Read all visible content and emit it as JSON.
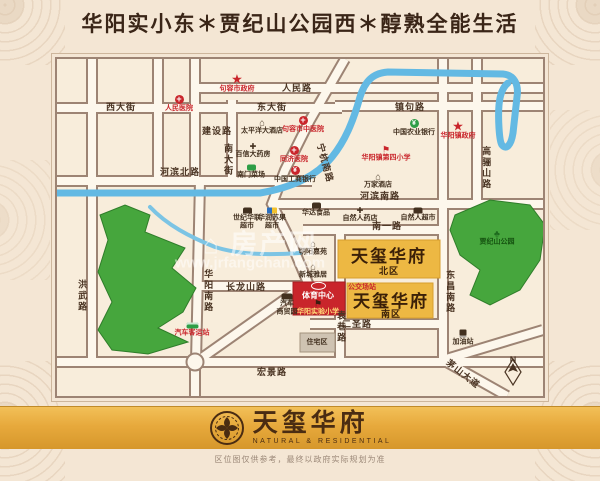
{
  "page": {
    "title": "华阳实小东＊贾纪山公园西＊醇熟全能生活",
    "disclaimer": "区位图仅供参考，最终以政府实际规划为准"
  },
  "logo": {
    "name": "天玺华府",
    "tagline": "NATURAL & RESIDENTIAL"
  },
  "watermark": {
    "text": "⌂ 房产网",
    "url": "www.jrfangchan.com"
  },
  "colors": {
    "background": "#f4e6d4",
    "map_background": "#f8eddb",
    "road_line": "#9d8474",
    "road_fill": "#fdf7ec",
    "river": "#63b9e3",
    "park": "#46a63d",
    "block_yellow": "#edb843",
    "block_red": "#c9252b",
    "banner_gold": "#e7a93c",
    "accent_red": "#c9252b",
    "text_dark": "#4a3423"
  },
  "map": {
    "labels": [
      {
        "text": "人民路",
        "x": 242,
        "y": 31,
        "cls": "road",
        "name": "road-renminlu"
      },
      {
        "text": "东大街",
        "x": 217,
        "y": 50,
        "cls": "road",
        "name": "road-dongdajie"
      },
      {
        "text": "西大街",
        "x": 66,
        "y": 50,
        "cls": "road",
        "name": "road-xidajie"
      },
      {
        "text": "建设路",
        "x": 162,
        "y": 74,
        "cls": "road",
        "name": "road-jianshelu"
      },
      {
        "text": "南大街",
        "x": 173,
        "y": 103,
        "cls": "road-v",
        "name": "road-nandajie"
      },
      {
        "text": "河滨北路",
        "x": 125,
        "y": 115,
        "cls": "road",
        "name": "road-hebinbeilu"
      },
      {
        "text": "宁杭南路",
        "x": 270,
        "y": 106,
        "cls": "road",
        "rot": 75,
        "name": "road-ninghangnanlu"
      },
      {
        "text": "镇句路",
        "x": 355,
        "y": 50,
        "cls": "road",
        "name": "road-zhenjulu"
      },
      {
        "text": "河滨南路",
        "x": 325,
        "y": 139,
        "cls": "road",
        "name": "road-hebinnanlu"
      },
      {
        "text": "南一路",
        "x": 332,
        "y": 169,
        "cls": "road",
        "name": "road-nanyilu"
      },
      {
        "text": "高骊山路",
        "x": 431,
        "y": 111,
        "cls": "road-v",
        "name": "road-gaolishanlu"
      },
      {
        "text": "长龙山路",
        "x": 191,
        "y": 230,
        "cls": "road",
        "name": "road-changlongshanlu"
      },
      {
        "text": "华阳南路",
        "x": 153,
        "y": 234,
        "cls": "road-v",
        "name": "road-huayangnanlu"
      },
      {
        "text": "洪武路",
        "x": 27,
        "y": 239,
        "cls": "road-v",
        "name": "road-hongwulu"
      },
      {
        "text": "东昌南路",
        "x": 395,
        "y": 235,
        "cls": "road-v",
        "name": "road-dongchangnanlu"
      },
      {
        "text": "二圣路",
        "x": 302,
        "y": 267,
        "cls": "road",
        "name": "road-ershenglu"
      },
      {
        "text": "袁巷路",
        "x": 286,
        "y": 270,
        "cls": "road-v",
        "name": "road-yuanxianglu"
      },
      {
        "text": "宏景路",
        "x": 217,
        "y": 315,
        "cls": "road",
        "name": "road-hongjinglu"
      },
      {
        "text": "茅山大道",
        "x": 408,
        "y": 317,
        "cls": "road",
        "rot": 38,
        "name": "road-maoshandadao"
      },
      {
        "text": "句容市政府",
        "x": 182,
        "y": 27,
        "cls": "poi-red",
        "icon": "star",
        "iconName": "government-star-icon",
        "name": "poi-jurong-government"
      },
      {
        "text": "人民医院",
        "x": 124,
        "y": 47,
        "cls": "poi-red",
        "icon": "cross",
        "iconName": "hospital-cross-icon",
        "name": "poi-renmin-hospital"
      },
      {
        "text": "句容市中医院",
        "x": 248,
        "y": 68,
        "cls": "poi-red",
        "icon": "cross",
        "iconName": "hospital-cross-icon",
        "name": "poi-tcm-hospital"
      },
      {
        "text": "同济医院",
        "x": 239,
        "y": 98,
        "cls": "poi-red",
        "icon": "cross",
        "iconName": "hospital-cross-icon",
        "name": "poi-tongji-hospital"
      },
      {
        "text": "华阳镇政府",
        "x": 403,
        "y": 74,
        "cls": "poi-red",
        "icon": "star",
        "iconName": "government-star-icon",
        "name": "poi-huayang-government"
      },
      {
        "text": "华阳镇第四小学",
        "x": 331,
        "y": 97,
        "cls": "poi-red",
        "icon": "school",
        "iconName": "school-icon",
        "name": "poi-no4-primary-school"
      },
      {
        "text": "汽车客运站",
        "x": 137,
        "y": 273,
        "cls": "poi-red",
        "icon": "bus",
        "iconName": "bus-icon",
        "name": "poi-coach-station"
      },
      {
        "text": "太平洋大酒店",
        "x": 207,
        "y": 70,
        "cls": "poi-dark",
        "icon": "hotel",
        "iconName": "hotel-icon",
        "name": "poi-pacific-hotel"
      },
      {
        "text": "百信大药房",
        "x": 198,
        "y": 94,
        "cls": "poi-dark",
        "icon": "pharmacy",
        "iconName": "pharmacy-icon",
        "name": "poi-baixin-pharmacy"
      },
      {
        "text": "南门菜场",
        "x": 196,
        "y": 115,
        "cls": "poi-dark",
        "icon": "market",
        "iconName": "market-icon",
        "name": "poi-nanmen-market"
      },
      {
        "text": "中国工商银行",
        "x": 240,
        "y": 118,
        "cls": "poi-dark",
        "icon": "bank-red",
        "iconName": "bank-icon",
        "name": "poi-icbc-bank"
      },
      {
        "text": "中国农业银行",
        "x": 359,
        "y": 71,
        "cls": "poi-dark",
        "icon": "bank-green",
        "iconName": "bank-icon",
        "name": "poi-abc-bank"
      },
      {
        "text": "万家酒店",
        "x": 323,
        "y": 124,
        "cls": "poi-dark",
        "icon": "hotel",
        "iconName": "hotel-icon",
        "name": "poi-wanjia-hotel"
      },
      {
        "text": "华达食品",
        "x": 261,
        "y": 153,
        "cls": "poi-dark",
        "icon": "shop",
        "iconName": "shop-icon",
        "name": "poi-huada-food"
      },
      {
        "text": "自然人药店",
        "x": 305,
        "y": 158,
        "cls": "poi-dark",
        "icon": "pharmacy",
        "iconName": "pharmacy-icon",
        "name": "poi-ziranren-pharmacy"
      },
      {
        "text": "自然人超市",
        "x": 363,
        "y": 158,
        "cls": "poi-dark",
        "icon": "shop",
        "iconName": "shop-icon",
        "name": "poi-ziranren-supermarket"
      },
      {
        "text": "世纪华联\n超市",
        "x": 192,
        "y": 162,
        "cls": "poi-dark",
        "icon": "cart",
        "iconName": "cart-icon",
        "name": "poi-hualian-supermarket"
      },
      {
        "text": "华润苏果\n超市",
        "x": 217,
        "y": 162,
        "cls": "poi-dark",
        "icon": "shop-color",
        "iconName": "suguo-shop-icon",
        "name": "poi-suguo-supermarket"
      },
      {
        "text": "朝阳嘉苑",
        "x": 258,
        "y": 191,
        "cls": "poi-dark",
        "icon": "home",
        "iconName": "residence-icon",
        "name": "poi-chaoyang-jiayuan"
      },
      {
        "text": "新城雅居",
        "x": 258,
        "y": 214,
        "cls": "poi-dark",
        "icon": "home",
        "iconName": "residence-icon",
        "name": "poi-xincheng-yaju"
      },
      {
        "text": "汽车\n商贸园",
        "x": 232,
        "y": 248,
        "cls": "poi-dark",
        "icon": "truck",
        "iconName": "truck-icon",
        "name": "poi-auto-trade-park"
      },
      {
        "text": "住宅区",
        "x": 262,
        "y": 286,
        "cls": "poi-dark",
        "name": "poi-residential-area"
      },
      {
        "text": "加油站",
        "x": 408,
        "y": 281,
        "cls": "poi-dark",
        "icon": "gas",
        "iconName": "gas-station-icon",
        "name": "poi-gas-station"
      },
      {
        "text": "贾纪山公园",
        "x": 442,
        "y": 181,
        "cls": "poi-park",
        "icon": "tree",
        "iconName": "tree-icon",
        "name": "poi-jiajishan-park"
      },
      {
        "text": "天玺华府",
        "x": 334,
        "y": 200,
        "cls": "block-big",
        "name": "estate-north-title"
      },
      {
        "text": "北区",
        "x": 334,
        "y": 214,
        "cls": "block-sub",
        "name": "estate-north-sub"
      },
      {
        "text": "公交场站",
        "x": 307,
        "y": 231,
        "cls": "block-red",
        "name": "poi-bus-depot"
      },
      {
        "text": "天玺华府",
        "x": 336,
        "y": 245,
        "cls": "block-big",
        "name": "estate-south-title"
      },
      {
        "text": "南区",
        "x": 336,
        "y": 257,
        "cls": "block-sub",
        "name": "estate-south-sub"
      },
      {
        "text": "体育中心",
        "x": 263,
        "y": 234,
        "cls": "rb-white",
        "icon": "oval",
        "iconName": "stadium-icon",
        "name": "poi-sports-center"
      },
      {
        "text": "华阳实验小学",
        "x": 263,
        "y": 251,
        "cls": "rb-yellow",
        "icon": "school-dark",
        "iconName": "school-icon",
        "name": "poi-experimental-primary-school"
      },
      {
        "text": "N",
        "x": 458,
        "y": 303,
        "cls": "compass-n",
        "name": "compass-north-label"
      }
    ]
  }
}
